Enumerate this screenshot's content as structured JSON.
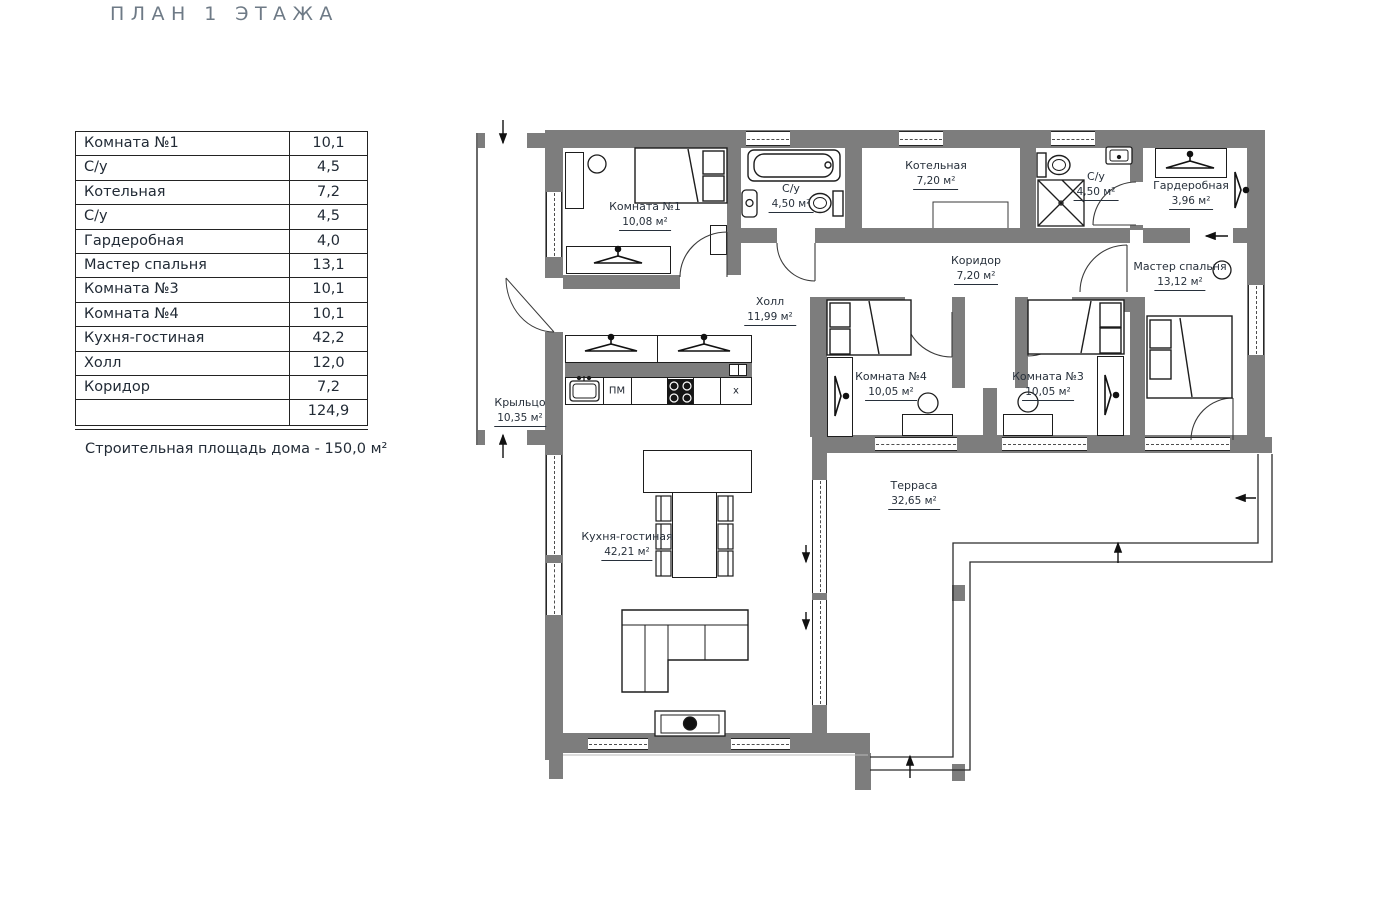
{
  "title": "ПЛАН 1 ЭТАЖА",
  "area_table": {
    "rows": [
      {
        "name": "Комната №1",
        "area": "10,1"
      },
      {
        "name": "С/у",
        "area": "4,5"
      },
      {
        "name": "Котельная",
        "area": "7,2"
      },
      {
        "name": "С/у",
        "area": "4,5"
      },
      {
        "name": "Гардеробная",
        "area": "4,0"
      },
      {
        "name": "Мастер спальня",
        "area": "13,1"
      },
      {
        "name": "Комната №3",
        "area": "10,1"
      },
      {
        "name": "Комната №4",
        "area": "10,1"
      },
      {
        "name": "Кухня-гостиная",
        "area": "42,2"
      },
      {
        "name": "Холл",
        "area": "12,0"
      },
      {
        "name": "Коридор",
        "area": "7,2"
      }
    ],
    "total": "124,9"
  },
  "note": "Строительная площадь дома - 150,0 м²",
  "rooms": [
    {
      "name": "Комната №1",
      "area": "10,08 м²"
    },
    {
      "name": "С/у",
      "area": "4,50 м²"
    },
    {
      "name": "Котельная",
      "area": "7,20 м²"
    },
    {
      "name": "С/у",
      "area": "4,50 м²"
    },
    {
      "name": "Гардеробная",
      "area": "3,96 м²"
    },
    {
      "name": "Коридор",
      "area": "7,20 м²"
    },
    {
      "name": "Мастер спальня",
      "area": "13,12 м²"
    },
    {
      "name": "Холл",
      "area": "11,99 м²"
    },
    {
      "name": "Комната №4",
      "area": "10,05 м²"
    },
    {
      "name": "Комната №3",
      "area": "10,05 м²"
    },
    {
      "name": "Кухня-гостиная",
      "area": "42,21 м²"
    },
    {
      "name": "Крыльцо",
      "area": "10,35 м²"
    },
    {
      "name": "Терраса",
      "area": "32,65 м²"
    }
  ],
  "kitchen_labels": {
    "pm": "ПМ",
    "x": "х"
  },
  "colors": {
    "wall": "#7d7d7d",
    "line": "#1d1d1d",
    "text": "#27303b",
    "title": "#6e7a86"
  }
}
